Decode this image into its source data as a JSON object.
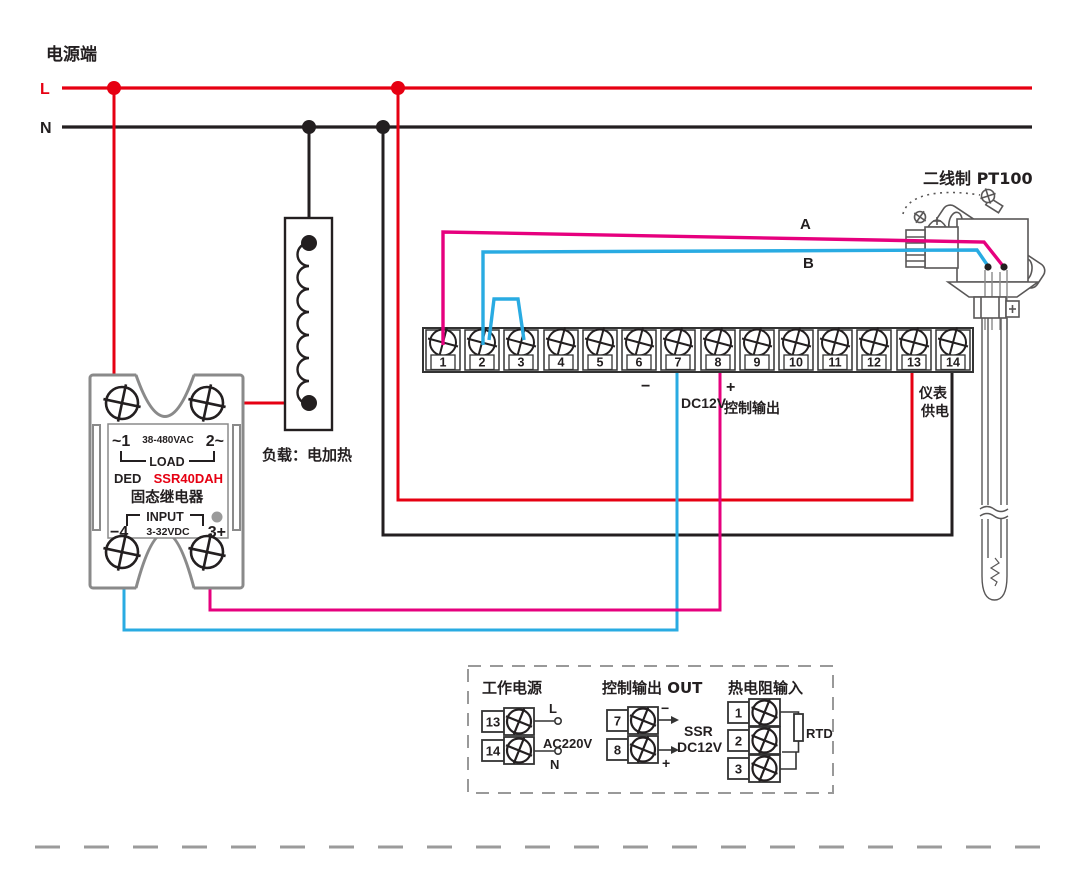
{
  "header": {
    "title": "电源端"
  },
  "power": {
    "l": "L",
    "n": "N"
  },
  "sensor": {
    "title": "二线制 PT100",
    "wire_a": "A",
    "wire_b": "B"
  },
  "load": {
    "caption": "负载：电加热"
  },
  "ssr": {
    "rating_left": "~1",
    "rating_mid": "38-480VAC",
    "rating_right": "2~",
    "load_word": "LOAD",
    "brand": "DED",
    "model": "SSR40DAH",
    "name_cn": "固态继电器",
    "input_word": "INPUT",
    "input_left": "−4",
    "input_mid": "3-32VDC",
    "input_right": "3+"
  },
  "strip": {
    "terminals": [
      "1",
      "2",
      "3",
      "4",
      "5",
      "6",
      "7",
      "8",
      "9",
      "10",
      "11",
      "12",
      "13",
      "14"
    ],
    "minus": "−",
    "plus": "+",
    "dc12v": "DC12V",
    "control_output": "控制输出",
    "meter_line1": "仪表",
    "meter_line2": "供电"
  },
  "detail": {
    "power": {
      "title": "工作电源",
      "t13": "13",
      "t14": "14",
      "l": "L",
      "ac": "AC220V",
      "n": "N"
    },
    "out": {
      "title": "控制输出 OUT",
      "t7": "7",
      "t8": "8",
      "minus": "−",
      "plus": "+",
      "ssr": "SSR",
      "dc12v": "DC12V"
    },
    "rtd": {
      "title": "热电阻输入",
      "t1": "1",
      "t2": "2",
      "t3": "3",
      "rtd": "RTD"
    }
  },
  "colors": {
    "line_red": "#e60012",
    "wire_magenta": "#e6007e",
    "wire_blue": "#29abe2",
    "wire_black": "#231f20",
    "outline_gray": "#595757",
    "dash_gray": "#9b9b9b"
  }
}
